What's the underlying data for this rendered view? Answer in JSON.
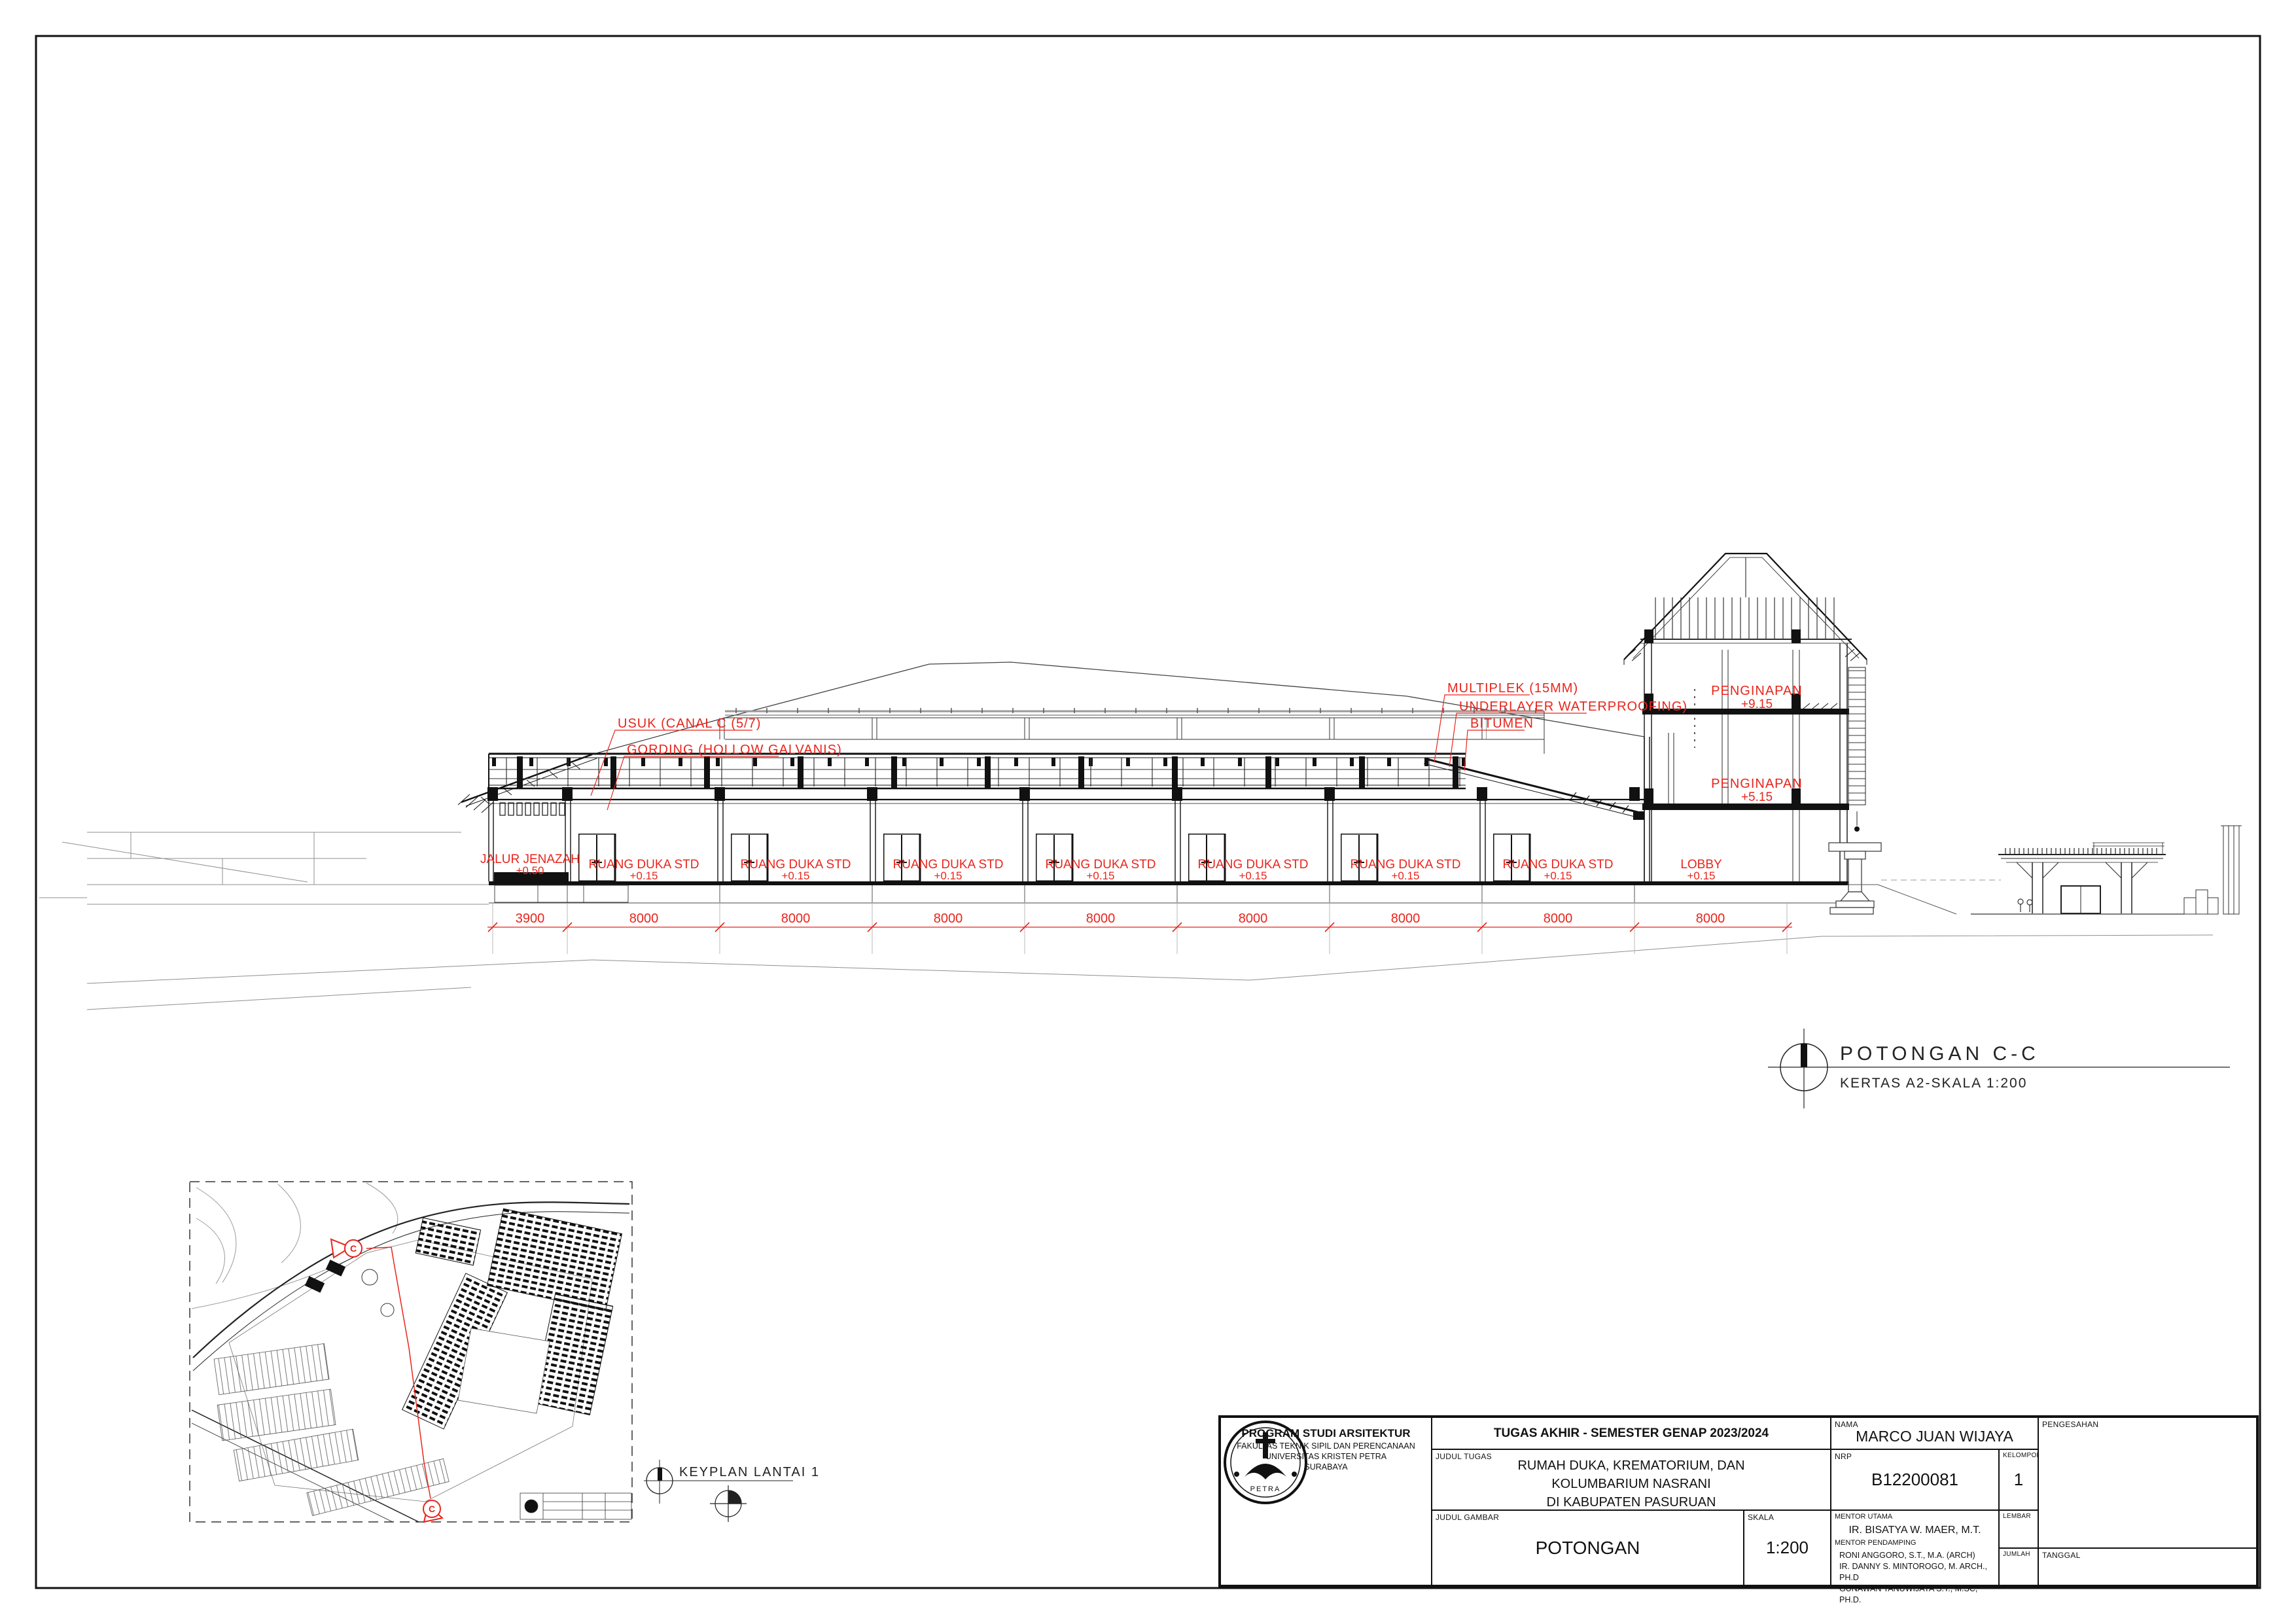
{
  "drawing": {
    "annotations_left": [
      {
        "label": "USUK (CANAL C (5/7)"
      },
      {
        "label": "GORDING (HOLLOW GALVANIS)"
      }
    ],
    "annotations_right": [
      {
        "label": "MULTIPLEK (15MM)"
      },
      {
        "label": "UNDERLAYER WATERPROOFING)"
      },
      {
        "label": "BITUMEN"
      }
    ],
    "tower_rooms": [
      {
        "name": "PENGINAPAN",
        "level": "+9.15"
      },
      {
        "name": "PENGINAPAN",
        "level": "+5.15"
      }
    ],
    "rooms": [
      {
        "name": "JALUR JENAZAH",
        "level": "+0.50"
      },
      {
        "name": "RUANG DUKA STD",
        "level": "+0.15"
      },
      {
        "name": "RUANG DUKA STD",
        "level": "+0.15"
      },
      {
        "name": "RUANG DUKA STD",
        "level": "+0.15"
      },
      {
        "name": "RUANG DUKA STD",
        "level": "+0.15"
      },
      {
        "name": "RUANG DUKA STD",
        "level": "+0.15"
      },
      {
        "name": "RUANG DUKA STD",
        "level": "+0.15"
      },
      {
        "name": "RUANG DUKA STD",
        "level": "+0.15"
      },
      {
        "name": "LOBBY",
        "level": "+0.15"
      }
    ],
    "dims": {
      "values": [
        "3900",
        "8000",
        "8000",
        "8000",
        "8000",
        "8000",
        "8000",
        "8000",
        "8000"
      ]
    }
  },
  "section_title": {
    "title": "POTONGAN C-C",
    "subtitle": "KERTAS A2-SKALA 1:200"
  },
  "keyplan": {
    "title": "KEYPLAN LANTAI 1",
    "marker": "C"
  },
  "titleblock": {
    "header": "TUGAS AKHIR - SEMESTER GENAP 2023/2024",
    "program": {
      "line1": "PROGRAM STUDI ARSITEKTUR",
      "line2": "FAKULTAS TEKNIK SIPIL DAN PERENCANAAN",
      "line3": "UNIVERSITAS KRISTEN PETRA",
      "line4": "SURABAYA"
    },
    "logo_text": "PETRA",
    "judul_tugas_label": "JUDUL TUGAS",
    "judul_tugas": [
      "RUMAH DUKA, KREMATORIUM, DAN",
      "KOLUMBARIUM NASRANI",
      "DI KABUPATEN PASURUAN"
    ],
    "judul_gambar_label": "JUDUL GAMBAR",
    "judul_gambar": "POTONGAN",
    "skala_label": "SKALA",
    "skala": "1:200",
    "nama_label": "NAMA",
    "nama": "MARCO JUAN WIJAYA",
    "nrp_label": "NRP",
    "nrp": "B12200081",
    "kelompok_label": "KELOMPOK",
    "kelompok": "1",
    "mentor_utama_label": "MENTOR UTAMA",
    "mentor_utama": "IR. BISATYA W. MAER, M.T.",
    "mentor_pendamping_label": "MENTOR PENDAMPING",
    "mentor_pendamping": [
      "RONI ANGGORO, S.T., M.A. (ARCH)",
      "IR. DANNY S. MINTOROGO, M. ARCH., PH.D",
      "GUNAWAN TANUWIJAYA S.T., M.SC, PH.D."
    ],
    "lembar_label": "LEMBAR",
    "jumlah_label": "JUMLAH",
    "pengesahan_label": "PENGESAHAN",
    "tanggal_label": "TANGGAL"
  }
}
